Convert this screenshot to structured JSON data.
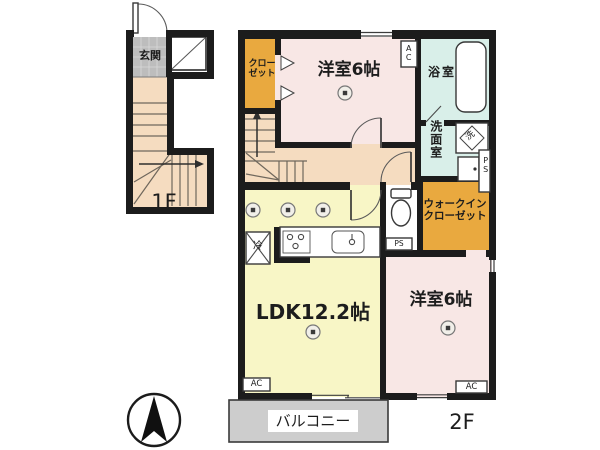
{
  "colors": {
    "wall": "#1c1c1c",
    "pink": "#f8e7e5",
    "yellow": "#f8f6c6",
    "orange": "#e9a93f",
    "cyan": "#d9efe9",
    "beige": "#f5dcc0",
    "genkan": "#bdbdbd",
    "balcony": "#cdcdcd",
    "tread": "#6f675c"
  },
  "floor1": {
    "label": "1F",
    "entrance": "玄関"
  },
  "floor2": {
    "label": "2F",
    "closet": {
      "line1": "クロー",
      "line2": "ゼット"
    },
    "bedroom_top": "洋室6帖",
    "bath": "浴室",
    "washroom": "洗面室",
    "washer": "洗",
    "ac_top": "AC",
    "ac_ldk": "AC",
    "ac_bedroom": "AC",
    "ps_washroom": "PS",
    "ps_toilet": "PS",
    "wic": {
      "line1": "ウォークイン",
      "line2": "クローゼット"
    },
    "ldk": "LDK12.2帖",
    "bedroom_right": "洋室6帖",
    "fridge": "冷",
    "balcony": "バルコニー"
  }
}
